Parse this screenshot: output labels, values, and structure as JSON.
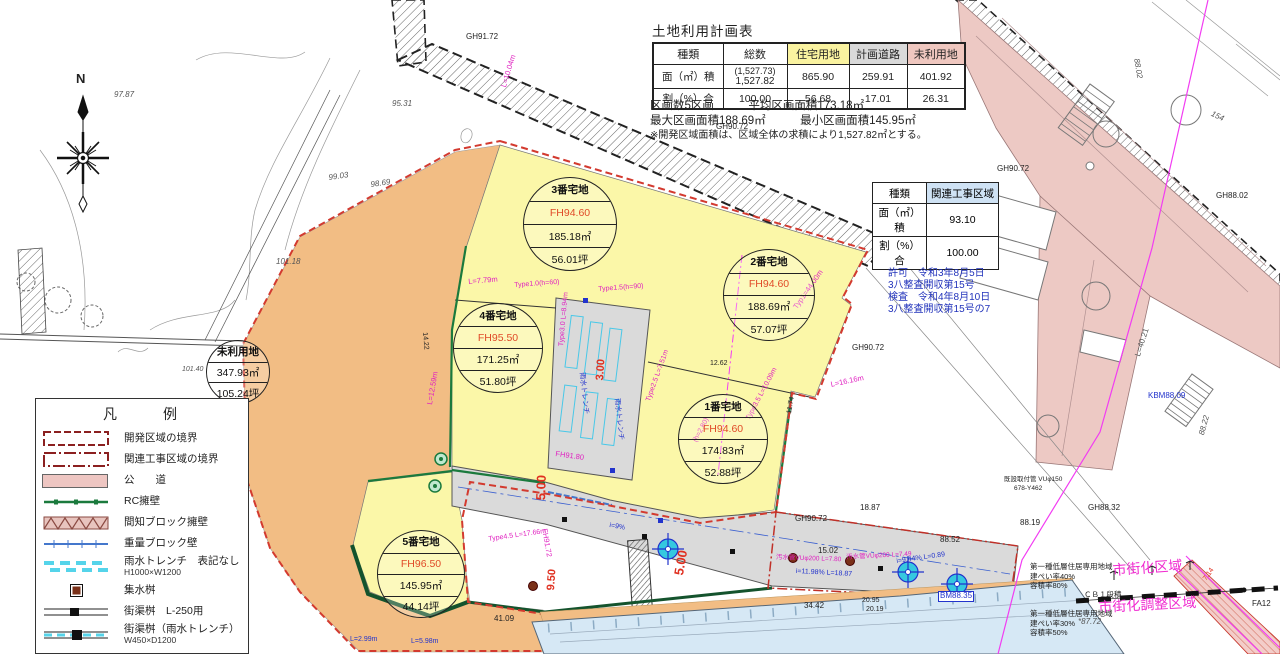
{
  "land_use_table": {
    "title": "土地利用計画表",
    "headers": [
      "種類",
      "総数",
      "住宅用地",
      "計画道路",
      "未利用地"
    ],
    "row_area": {
      "label": "面（㎡）積",
      "total_paren": "(1,527.73)",
      "total": "1,527.82",
      "residential": "865.90",
      "road": "259.91",
      "unused": "401.92"
    },
    "row_ratio": {
      "label": "割（%）合",
      "total": "100.00",
      "residential": "56.68",
      "road": "17.01",
      "unused": "26.31"
    }
  },
  "notes": [
    "区画数5区画　　　平均区画面積173.18㎡",
    "最大区画面積188.69㎡　　　最小区画面積145.95㎡",
    "※開発区域面積は、区域全体の求積により1,527.82㎡とする。"
  ],
  "related_table": {
    "header_label": "種類",
    "header_value": "関連工事区域",
    "area_label": "面（㎡）積",
    "area_value": "93.10",
    "ratio_label": "割（%）合",
    "ratio_value": "100.00"
  },
  "permit": [
    "許可　令和3年8月5日",
    "3八整査開収第15号",
    "検査　令和4年8月10日",
    "3八整査開収第15号の7"
  ],
  "legend": {
    "title": "凡　　例",
    "items": [
      {
        "label": "開発区域の境界",
        "sub": ""
      },
      {
        "label": "関連工事区域の境界",
        "sub": ""
      },
      {
        "label": "公　　道",
        "sub": ""
      },
      {
        "label": "RC擁壁",
        "sub": ""
      },
      {
        "label": "間知ブロック擁壁",
        "sub": ""
      },
      {
        "label": "重量ブロック壁",
        "sub": ""
      },
      {
        "label": "雨水トレンチ　表記なし",
        "sub": "H1000×W1200"
      },
      {
        "label": "集水桝",
        "sub": ""
      },
      {
        "label": "街渠桝　L-250用",
        "sub": ""
      },
      {
        "label": "街渠桝（雨水トレンチ）",
        "sub": "W450×D1200"
      }
    ]
  },
  "stamps": [
    {
      "name": "parcel-3",
      "x": 569,
      "y": 223,
      "r": 46,
      "rows": [
        {
          "t": "3番宅地",
          "b": 1
        },
        {
          "t": "FH94.60",
          "c": "#e04a28"
        },
        {
          "t": "185.18㎡"
        },
        {
          "t": "56.01坪"
        }
      ]
    },
    {
      "name": "parcel-2",
      "x": 768,
      "y": 294,
      "r": 45,
      "rows": [
        {
          "t": "2番宅地",
          "b": 1
        },
        {
          "t": "FH94.60",
          "c": "#e04a28"
        },
        {
          "t": "188.69㎡"
        },
        {
          "t": "57.07坪"
        }
      ]
    },
    {
      "name": "parcel-4",
      "x": 497,
      "y": 347,
      "r": 44,
      "rows": [
        {
          "t": "4番宅地",
          "b": 1
        },
        {
          "t": "FH95.50",
          "c": "#e04a28"
        },
        {
          "t": "171.25㎡"
        },
        {
          "t": "51.80坪"
        }
      ]
    },
    {
      "name": "parcel-1",
      "x": 722,
      "y": 438,
      "r": 44,
      "rows": [
        {
          "t": "1番宅地",
          "b": 1
        },
        {
          "t": "FH94.60",
          "c": "#e04a28"
        },
        {
          "t": "174.83㎡"
        },
        {
          "t": "52.88坪"
        }
      ]
    },
    {
      "name": "parcel-5",
      "x": 420,
      "y": 573,
      "r": 43,
      "rows": [
        {
          "t": "5番宅地",
          "b": 1
        },
        {
          "t": "FH96.50",
          "c": "#e04a28"
        },
        {
          "t": "145.95㎡"
        },
        {
          "t": "44.14坪"
        }
      ]
    },
    {
      "name": "unused-land",
      "x": 237,
      "y": 371,
      "r": 31,
      "rows": [
        {
          "t": "未利用地",
          "b": 1
        },
        {
          "t": "347.93㎡"
        },
        {
          "t": "105.24坪"
        }
      ]
    }
  ],
  "labels": [
    {
      "t": "N",
      "x": 76,
      "y": 72,
      "s": 13,
      "b": 1,
      "n": "compass-north-label"
    },
    {
      "t": "GH91.72",
      "x": 466,
      "y": 33
    },
    {
      "t": "GH90.72",
      "x": 716,
      "y": 123
    },
    {
      "t": "GH90.72",
      "x": 997,
      "y": 165
    },
    {
      "t": "GH90.72",
      "x": 852,
      "y": 344
    },
    {
      "t": "GH90.72",
      "x": 795,
      "y": 515
    },
    {
      "t": "95.31",
      "x": 392,
      "y": 100,
      "i": 1,
      "c": "#555"
    },
    {
      "t": "99.03",
      "x": 328,
      "y": 174,
      "i": 1,
      "c": "#555",
      "r": -8
    },
    {
      "t": "98.69",
      "x": 370,
      "y": 181,
      "i": 1,
      "c": "#555",
      "r": -8
    },
    {
      "t": "97.87",
      "x": 114,
      "y": 91,
      "i": 1,
      "c": "#555"
    },
    {
      "t": "101.18",
      "x": 276,
      "y": 258,
      "i": 1,
      "c": "#555"
    },
    {
      "t": "101.40",
      "x": 182,
      "y": 366,
      "i": 1,
      "c": "#555",
      "s": 7
    },
    {
      "t": "101.72",
      "x": 190,
      "y": 417,
      "i": 1,
      "c": "#555",
      "z": 4
    },
    {
      "t": "102.36",
      "x": 164,
      "y": 588,
      "i": 1,
      "c": "#555",
      "z": 4
    },
    {
      "t": "88.02",
      "x": 1140,
      "y": 58,
      "r": 80,
      "i": 1,
      "c": "#555"
    },
    {
      "t": "154",
      "x": 1213,
      "y": 110,
      "r": 25,
      "i": 1,
      "c": "#555"
    },
    {
      "t": "88.22",
      "x": 1198,
      "y": 434,
      "r": -75,
      "i": 1,
      "c": "#555"
    },
    {
      "t": "GH88.32",
      "x": 1088,
      "y": 504
    },
    {
      "t": "GH88.02",
      "x": 1216,
      "y": 192
    },
    {
      "t": "88.52",
      "x": 940,
      "y": 536
    },
    {
      "t": "88.19",
      "x": 1020,
      "y": 519
    },
    {
      "t": "18.87",
      "x": 860,
      "y": 504
    },
    {
      "t": "15.02",
      "x": 818,
      "y": 547
    },
    {
      "t": "34.42",
      "x": 804,
      "y": 602
    },
    {
      "t": "20.95",
      "x": 862,
      "y": 597,
      "s": 7
    },
    {
      "t": "20.19",
      "x": 866,
      "y": 606,
      "s": 7
    },
    {
      "t": "41.09",
      "x": 494,
      "y": 615
    },
    {
      "t": "12.62",
      "x": 710,
      "y": 360,
      "s": 7
    },
    {
      "t": "11.74",
      "x": 786,
      "y": 413,
      "r": -80,
      "s": 7
    },
    {
      "t": "14.22",
      "x": 428,
      "y": 332,
      "r": 85,
      "s": 7
    },
    {
      "t": "L=40.21",
      "x": 1134,
      "y": 355,
      "r": -72,
      "c": "#555"
    },
    {
      "t": "KBM88.09",
      "x": 1148,
      "y": 392,
      "c": "#2233cc"
    },
    {
      "t": "BM88.35",
      "x": 938,
      "y": 591,
      "c": "#2233cc",
      "bx": 1
    },
    {
      "t": "i=11.98% L=18.87",
      "x": 796,
      "y": 568,
      "c": "#2233cc",
      "s": 7,
      "r": 3
    },
    {
      "t": "i=9.44% L=0.89",
      "x": 896,
      "y": 558,
      "c": "#2233cc",
      "s": 7,
      "r": -8
    },
    {
      "t": "L=2.99m",
      "x": 350,
      "y": 636,
      "c": "#2233cc",
      "s": 7
    },
    {
      "t": "L=5.98m",
      "x": 411,
      "y": 638,
      "c": "#2233cc",
      "s": 7
    },
    {
      "t": "i=9%",
      "x": 610,
      "y": 522,
      "c": "#2233cc",
      "s": 7,
      "r": 10
    },
    {
      "t": "雨水トレンチ",
      "x": 585,
      "y": 372,
      "c": "#2233cc",
      "s": 7,
      "r": 84
    },
    {
      "t": "雨水トレンチ",
      "x": 620,
      "y": 398,
      "c": "#2233cc",
      "s": 7,
      "r": 84
    },
    {
      "t": "L=10.04m",
      "x": 500,
      "y": 86,
      "c": "#e020c0",
      "r": -73,
      "s": 7.5
    },
    {
      "t": "L=7.79m",
      "x": 468,
      "y": 278,
      "c": "#e020c0",
      "r": -5,
      "s": 7.5
    },
    {
      "t": "Type1.0(h=60)",
      "x": 514,
      "y": 282,
      "c": "#e020c0",
      "r": -4,
      "s": 7
    },
    {
      "t": "Type1.5(h=90)",
      "x": 598,
      "y": 286,
      "c": "#e020c0",
      "r": -4,
      "s": 7
    },
    {
      "t": "Typ1=44.00m",
      "x": 792,
      "y": 306,
      "c": "#e020c0",
      "r": -55,
      "s": 7.5
    },
    {
      "t": "L=16.16m",
      "x": 830,
      "y": 381,
      "c": "#e020c0",
      "r": -12,
      "s": 7.5
    },
    {
      "t": "Type2.5 L=7.51m",
      "x": 645,
      "y": 400,
      "c": "#e020c0",
      "r": -70,
      "s": 7
    },
    {
      "t": "Type3.5 L=10.09m",
      "x": 745,
      "y": 418,
      "c": "#e020c0",
      "r": -62,
      "s": 7
    },
    {
      "t": "(h=2.80)",
      "x": 692,
      "y": 440,
      "c": "#e020c0",
      "r": -62,
      "s": 7
    },
    {
      "t": "Type3.0 L=8.94m",
      "x": 558,
      "y": 346,
      "c": "#e020c0",
      "r": -85,
      "s": 7
    },
    {
      "t": "Type4.5 L=17.66m",
      "x": 488,
      "y": 536,
      "c": "#e020c0",
      "r": -8,
      "s": 7
    },
    {
      "t": "L=12.59m",
      "x": 426,
      "y": 404,
      "c": "#e020c0",
      "r": -80,
      "s": 7.5
    },
    {
      "t": "FH91.80",
      "x": 556,
      "y": 450,
      "c": "#e020c0",
      "r": 8,
      "s": 7.5
    },
    {
      "t": "FH91.72",
      "x": 548,
      "y": 528,
      "c": "#e020c0",
      "r": 80,
      "s": 7.5
    },
    {
      "t": "汚水管VUφ200 L=7.80",
      "x": 776,
      "y": 554,
      "c": "#e020c0",
      "s": 6.5,
      "r": 2
    },
    {
      "t": "汚水管VUφ200 L=7.49",
      "x": 846,
      "y": 554,
      "c": "#e020c0",
      "s": 6.5,
      "r": -3
    },
    {
      "t": "FH101.00",
      "x": 196,
      "y": 625,
      "c": "#e020c0",
      "s": 7.5,
      "z": 4
    },
    {
      "t": "5.00",
      "x": 534,
      "y": 500,
      "c": "#e03020",
      "r": -88,
      "s": 13,
      "b": 1
    },
    {
      "t": "5.00",
      "x": 672,
      "y": 574,
      "c": "#e03020",
      "r": -80,
      "s": 13,
      "b": 1
    },
    {
      "t": "3.00",
      "x": 594,
      "y": 380,
      "c": "#e03020",
      "r": -86,
      "s": 11,
      "b": 1
    },
    {
      "t": "9.50",
      "x": 545,
      "y": 590,
      "c": "#e03020",
      "r": -86,
      "s": 11,
      "b": 1
    },
    {
      "t": "7.14",
      "x": 1202,
      "y": 578,
      "c": "#e03020",
      "r": -55,
      "s": 7
    },
    {
      "t": "既設取付管 VUφ150",
      "x": 1004,
      "y": 476,
      "s": 6.5
    },
    {
      "t": "678-Y462",
      "x": 1014,
      "y": 485,
      "s": 6.5
    },
    {
      "t": "第一種低層住居専用地域",
      "x": 1030,
      "y": 563,
      "s": 7.5
    },
    {
      "t": "建ぺい率40%",
      "x": 1030,
      "y": 573,
      "s": 7.5
    },
    {
      "t": "容積率80%",
      "x": 1030,
      "y": 582,
      "s": 7.5
    },
    {
      "t": "市街化区域",
      "x": 1112,
      "y": 563,
      "c": "#f02bd0",
      "s": 14,
      "r": -4
    },
    {
      "t": "ＣＢ１段積",
      "x": 1084,
      "y": 591,
      "s": 7.5
    },
    {
      "t": "市街化調整区域",
      "x": 1098,
      "y": 600,
      "c": "#f02bd0",
      "s": 14,
      "r": -3
    },
    {
      "t": "第一種低層住居専用地域",
      "x": 1030,
      "y": 610,
      "s": 7.5
    },
    {
      "t": "建ぺい率30%",
      "x": 1030,
      "y": 620,
      "s": 7.5
    },
    {
      "t": "容積率50%",
      "x": 1030,
      "y": 629,
      "s": 7.5
    },
    {
      "t": "*87.72",
      "x": 1078,
      "y": 618,
      "i": 1,
      "c": "#555"
    },
    {
      "t": "FA12",
      "x": 1252,
      "y": 600
    }
  ],
  "colors": {
    "residential_fill": "#fbf7a8",
    "unused_fill": "#f2bd84",
    "planned_road_fill": "#d9d9d9",
    "public_road_fill": "#edc9c4",
    "water_fill": "#d6e8f5",
    "boundary_red": "#d33a2f",
    "annotation_magenta": "#e020c0",
    "annotation_blue": "#2233cc",
    "fh_red": "#e04a28",
    "zone_magenta": "#f02bd0",
    "wall_green": "#1b7a3d"
  }
}
